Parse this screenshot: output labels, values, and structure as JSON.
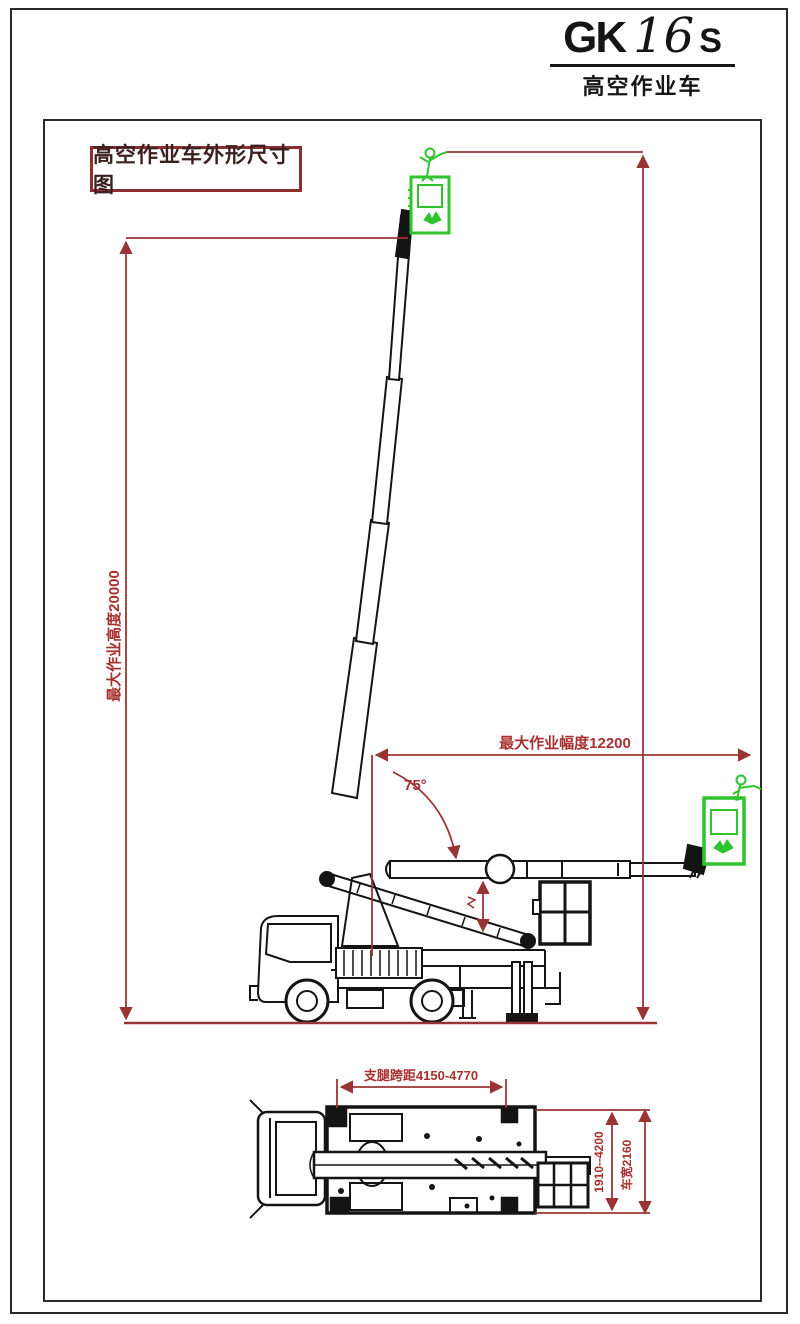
{
  "logo": {
    "model_prefix": "GK",
    "model_number": "16",
    "model_suffix": "S",
    "subtitle": "高空作业车"
  },
  "drawing": {
    "title": "高空作业车外形尺寸图",
    "labels": {
      "max_working_height": "最大作业高度20000",
      "max_working_radius": "最大作业幅度12200",
      "boom_angle": "75°",
      "outrigger_long_span": "支腿跨距4150-4770",
      "outrigger_trans_span": "1910--4200",
      "vehicle_width": "车宽2160"
    },
    "colors": {
      "dimension_red": "#9a3434",
      "label_red": "#a83030",
      "line_black": "#141414",
      "highlight_green": "#2fc42f"
    }
  }
}
